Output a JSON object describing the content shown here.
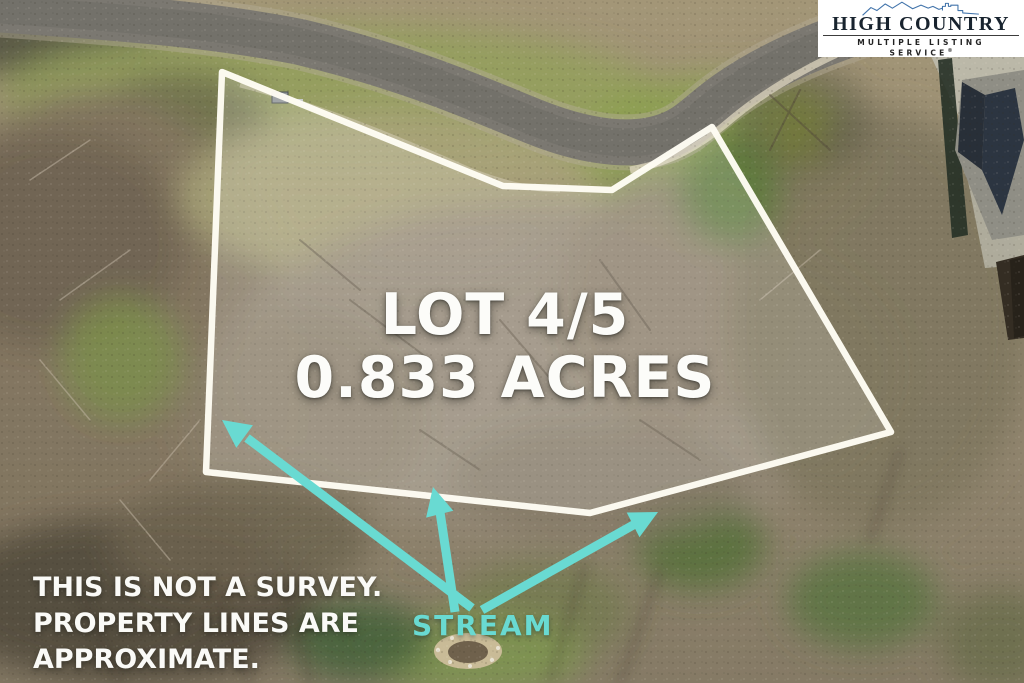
{
  "overlay": {
    "lot_label": {
      "line1": "LOT 4/5",
      "line2": "0.833 ACRES"
    },
    "disclaimer": {
      "line1": "THIS IS NOT A SURVEY.",
      "line2": "PROPERTY LINES ARE",
      "line3": "APPROXIMATE."
    },
    "stream_label": "STREAM",
    "colors": {
      "annotation_teal": "#69dad2",
      "boundary_white": "#fffdf4",
      "label_white": "#fcfcf9"
    }
  },
  "logo": {
    "title": "HIGH COUNTRY",
    "tagline": "MULTIPLE LISTING SERVICE",
    "registered_mark": "®",
    "colors": {
      "brand_blue": "#4274ab",
      "title_color": "#18232e",
      "background": "#ffffff"
    }
  }
}
